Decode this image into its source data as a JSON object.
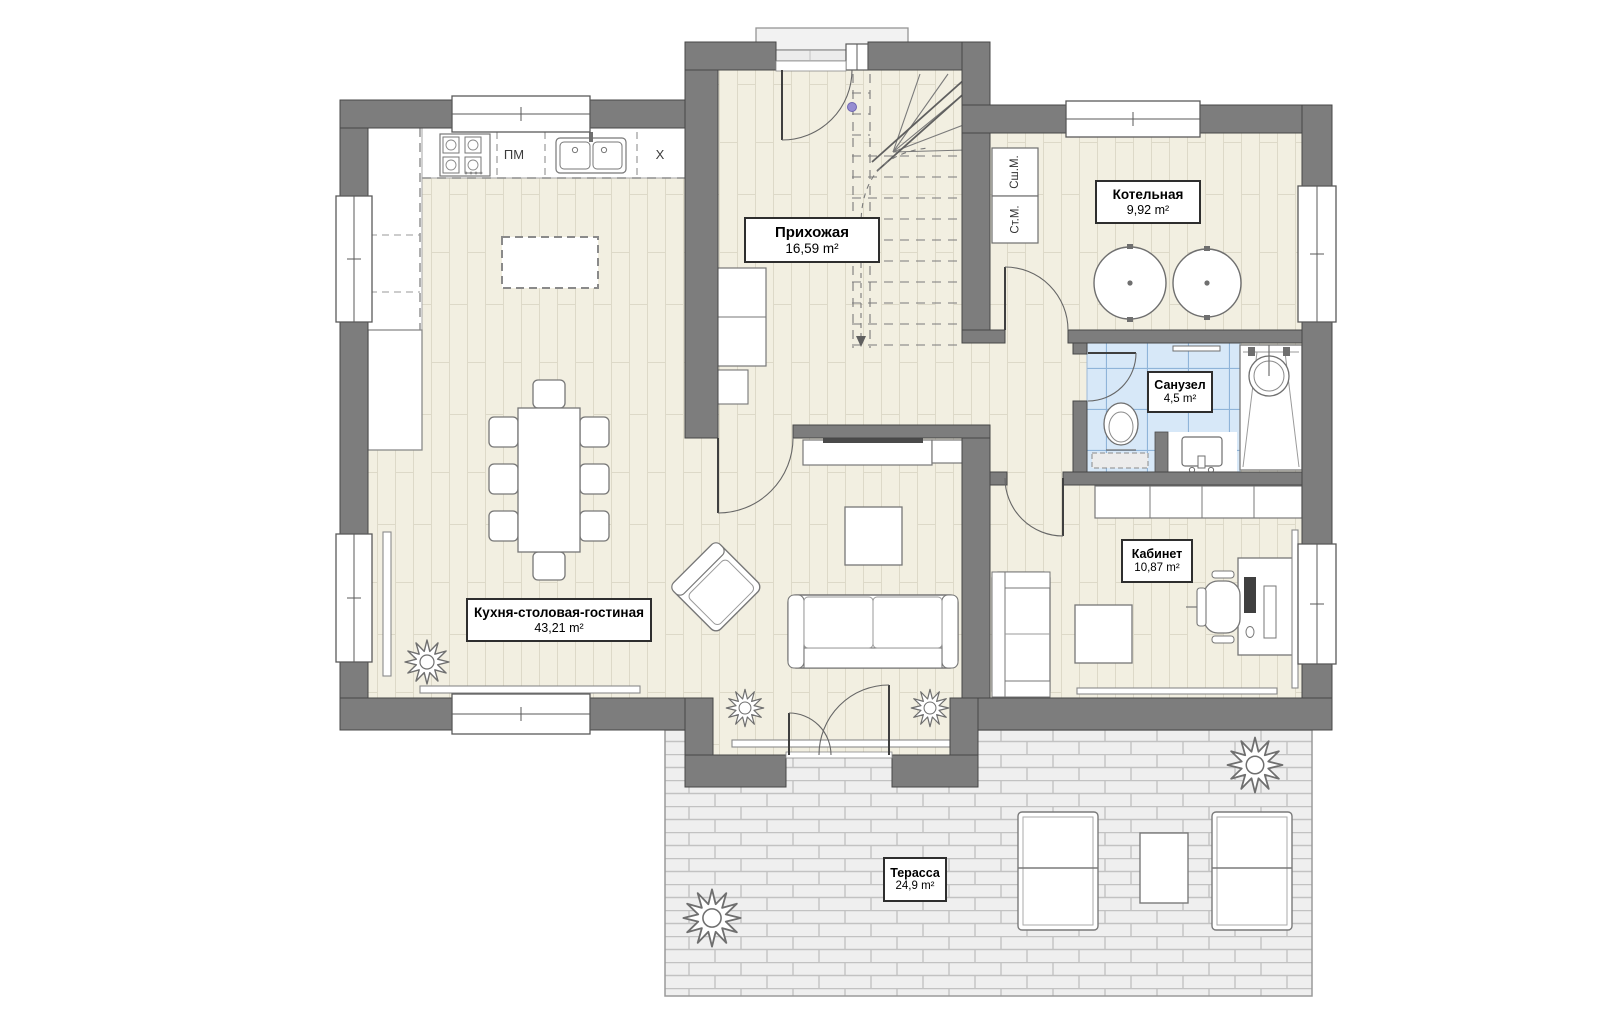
{
  "plan": {
    "title": "План первого этажа",
    "rooms": [
      {
        "name": "Прихожая",
        "area": "16,59 m²"
      },
      {
        "name": "Котельная",
        "area": "9,92 m²"
      },
      {
        "name": "Санузел",
        "area": "4,5 m²"
      },
      {
        "name": "Кабинет",
        "area": "10,87 m²"
      },
      {
        "name": "Кухня-столовая-гостиная",
        "area": "43,21 m²"
      },
      {
        "name": "Терасса",
        "area": "24,9 m²"
      }
    ],
    "appliance_labels": {
      "dishwasher": "ПМ",
      "fridge": "X",
      "dryer": "Сш.М.",
      "washer": "Ст.М."
    },
    "colors": {
      "wall": "#7d7d7d",
      "floor": "#f2efe1",
      "bathroom_tile": "#d7e8f8",
      "terrace_paving": "#efefef",
      "door_pin_dot": "#968dd2"
    }
  }
}
